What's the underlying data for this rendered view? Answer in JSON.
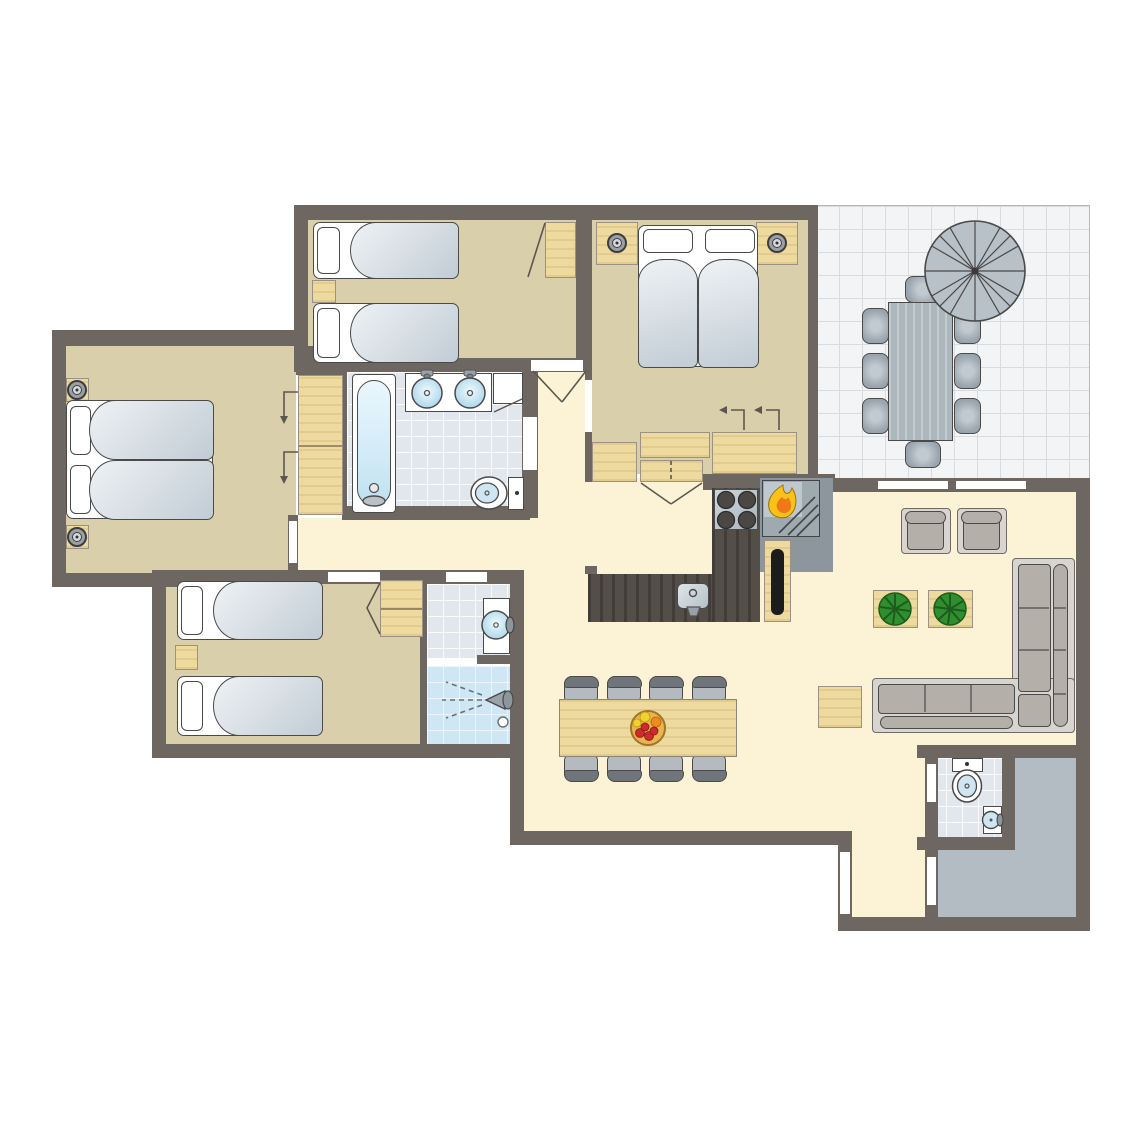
{
  "title": "holiday-home-floor-plan",
  "canvas": {
    "width": 1145,
    "height": 1145,
    "background": "#ffffff"
  },
  "palette": {
    "wall": "#6e6761",
    "floor_bedroom": "#d9cfab",
    "floor_hall": "#fcf3d7",
    "tile_bath": "#e2e7ee",
    "tile_shower": "#cfe7f5",
    "tile_outdoor": "#f2f4f6",
    "tile_outdoor_line": "#d8dcdf",
    "porch": "#b4bcc3",
    "wood": "#eeda9f",
    "wood_border": "#9b9283",
    "counter_dark": "#544e49",
    "appliance_gray": "#b9c2c9",
    "fireplace_gray": "#8d969d",
    "blanket_light": "#eef2f5",
    "blanket_dark": "#c2ccd5",
    "outline": "#4a4a4a",
    "sofa_gray": "#b4afa9",
    "sofa_frame": "#d8d5d0",
    "chair_gray": "#b4bac0",
    "chair_back": "#70757b",
    "outdoor_furniture": "#9aa4ad",
    "water_blue": "#cfe6f2",
    "plant_green": "#2f8f2f",
    "flame_yellow": "#f9c21a",
    "flame_orange": "#f07818",
    "fruit_red": "#cc2b2b",
    "fruit_orange": "#ef8b1f",
    "fruit_yellow": "#f2d12e",
    "tv_black": "#1c1c1c"
  },
  "rooms": [
    {
      "id": "bedroom-top-left",
      "type": "bedroom",
      "furniture": [
        "single bed",
        "single bed",
        "nightstand",
        "wardrobe"
      ]
    },
    {
      "id": "bedroom-top-right",
      "type": "bedroom",
      "furniture": [
        "double bed",
        "nightstand with lamp",
        "nightstand with lamp",
        "closets"
      ]
    },
    {
      "id": "bedroom-master",
      "type": "bedroom",
      "furniture": [
        "double bed",
        "nightstand with lamp",
        "nightstand with lamp",
        "wardrobe"
      ]
    },
    {
      "id": "bedroom-bottom-left",
      "type": "bedroom",
      "furniture": [
        "single bed",
        "single bed",
        "nightstand",
        "wardrobe"
      ]
    },
    {
      "id": "bathroom-main",
      "type": "bathroom",
      "fixtures": [
        "bathtub",
        "washbasin",
        "washbasin",
        "toilet",
        "shelf"
      ]
    },
    {
      "id": "shower-room",
      "type": "bathroom",
      "fixtures": [
        "washbasin",
        "shower",
        "drain"
      ]
    },
    {
      "id": "wc",
      "type": "toilet-room",
      "fixtures": [
        "toilet",
        "washbasin"
      ]
    },
    {
      "id": "kitchen",
      "type": "kitchen",
      "fixtures": [
        "L-shaped counter",
        "hob 4 burners",
        "sink",
        "fireplace",
        "tv cabinet"
      ]
    },
    {
      "id": "living-room",
      "type": "living",
      "furniture": [
        "armchair",
        "armchair",
        "plant table",
        "plant table",
        "corner sofa",
        "coffee table"
      ]
    },
    {
      "id": "dining-area",
      "type": "dining",
      "furniture": [
        "dining table",
        "8 chairs",
        "fruit bowl"
      ]
    },
    {
      "id": "terrace",
      "type": "outdoor",
      "furniture": [
        "outdoor table",
        "8 outdoor chairs",
        "parasol"
      ]
    },
    {
      "id": "entrance-hall",
      "type": "hall",
      "furniture": []
    },
    {
      "id": "porch",
      "type": "outdoor",
      "furniture": []
    }
  ],
  "counts": {
    "bedrooms": 4,
    "beds_single": 4,
    "beds_double": 2,
    "bathrooms": 2,
    "toilets": 2,
    "dining_chairs": 8,
    "outdoor_chairs": 8
  }
}
